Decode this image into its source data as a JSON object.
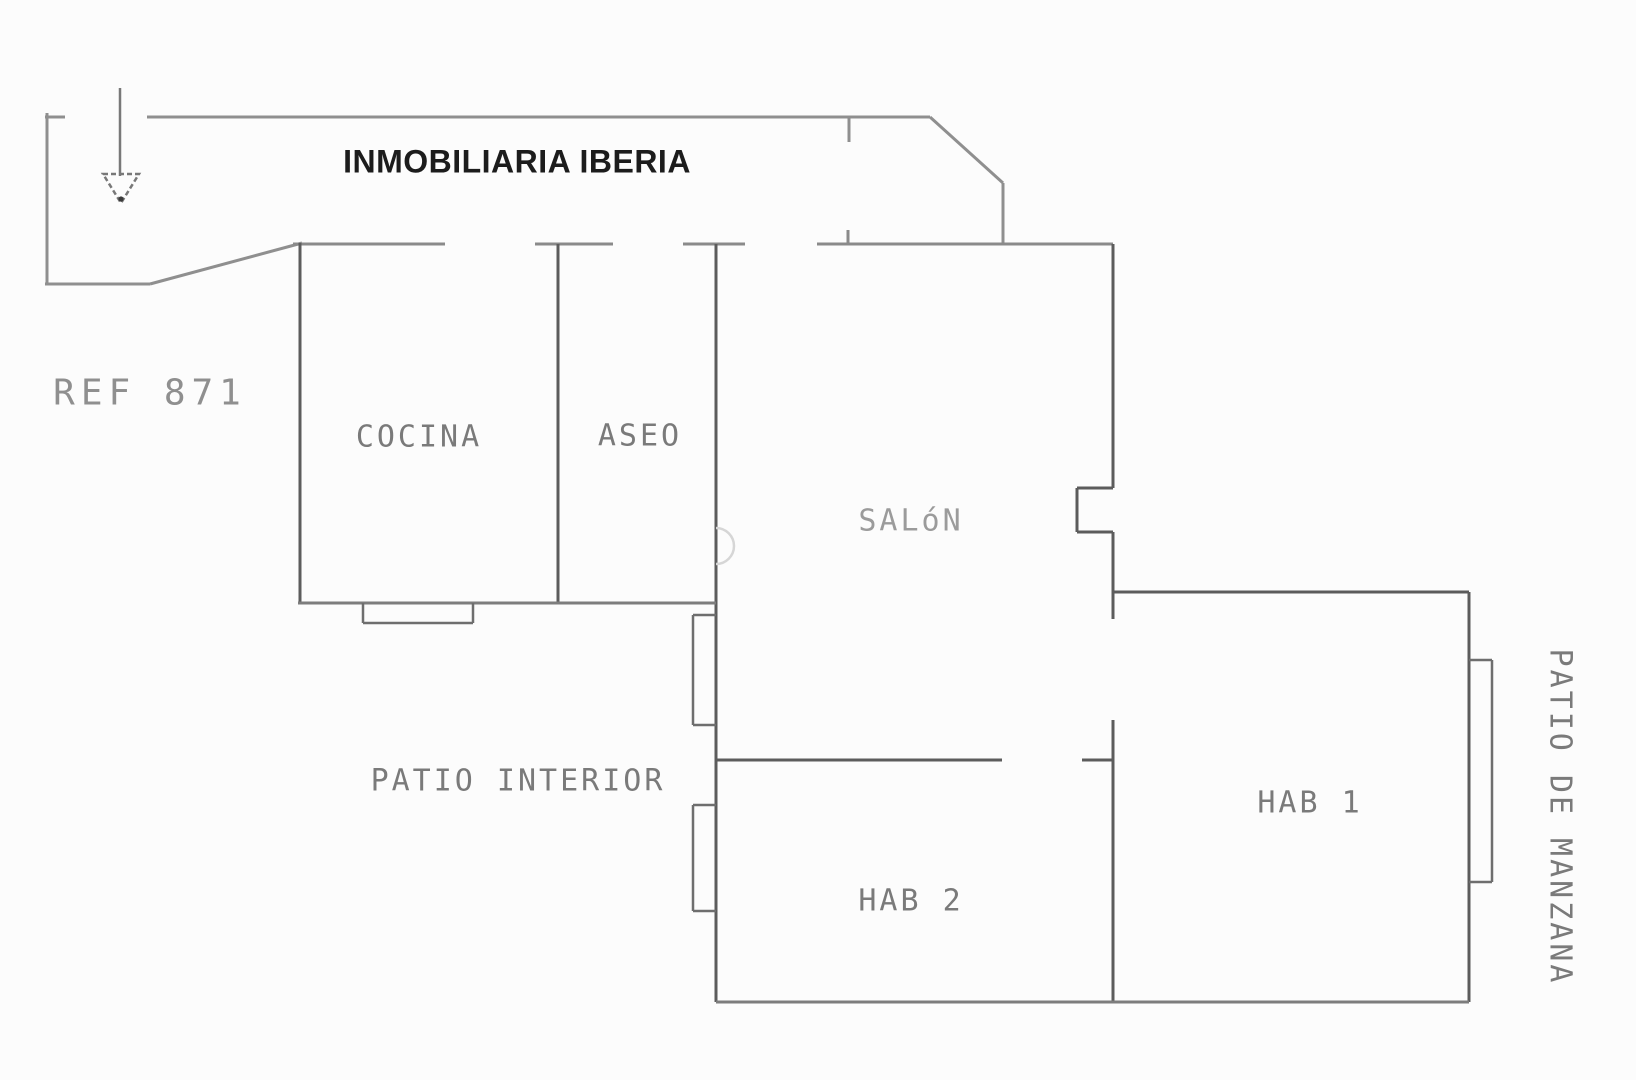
{
  "header": {
    "agency_title": "INMOBILIARIA IBERIA",
    "reference": "REF 871"
  },
  "rooms": {
    "kitchen": "COCINA",
    "bathroom": "ASEO",
    "living_room": "SALóN",
    "bedroom_1": "HAB 1",
    "bedroom_2": "HAB 2"
  },
  "outdoor": {
    "inner_patio": "PATIO INTERIOR",
    "block_patio": "PATIO DE MANZANA"
  },
  "icons": {
    "entrance_arrow": "entrance-arrow-icon"
  },
  "colors": {
    "outer_wall": "#8f8f8f",
    "inner_wall": "#5c5c5c",
    "light_wall": "#7d7d7d",
    "title_text": "#1c1c1c",
    "label_text": "#7a7a7a",
    "background": "#fcfcfc"
  }
}
